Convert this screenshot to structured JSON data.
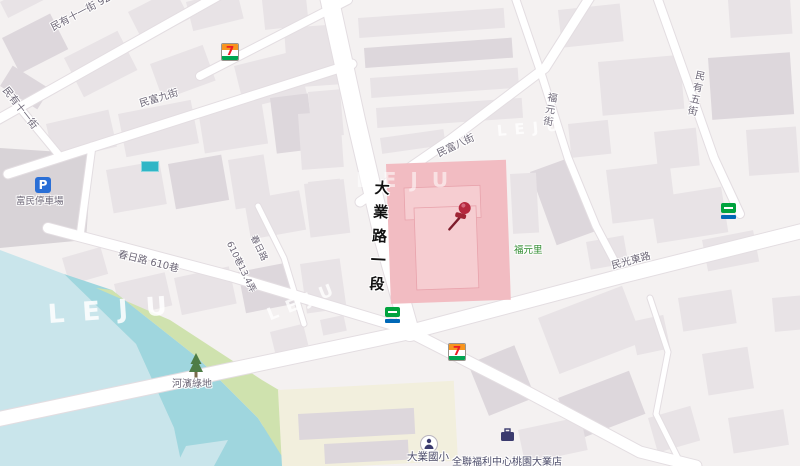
{
  "map": {
    "watermark": "LEJU",
    "labels": {
      "street_minyou11": "民有十一街 92巷",
      "street_minyou11_side": "民有十一街",
      "street_minfu9": "民富九街",
      "street_minfu8": "民富八街",
      "street_fuyuan": "福元街",
      "street_minyou5": "民有五街",
      "street_daye": "大業路一段",
      "street_chunri610": "春日路 610巷",
      "street_chunri": "春日路",
      "street_lane610": "610巷13.4弄",
      "street_minguang": "民光東路",
      "parking": "富民停車場",
      "park": "河濱綠地",
      "village": "福元里",
      "school": "大業國小",
      "store": "全聯福利中心桃園大業店",
      "parking_icon_letter": "P",
      "seven_eleven_digit": "7"
    },
    "colors": {
      "background": "#f4f1f1",
      "building": "#e8e3e6",
      "road": "#ffffff",
      "water_dark": "#9fd6de",
      "water_light": "#c9e5eb",
      "park_green": "#cfe2ae",
      "parking_lot": "#d8d3d7",
      "highlight_block": "#f2bcc2",
      "marker_pin": "#b5273d",
      "parking_icon": "#2a6fd6",
      "village_text": "#2e8b2e"
    }
  }
}
